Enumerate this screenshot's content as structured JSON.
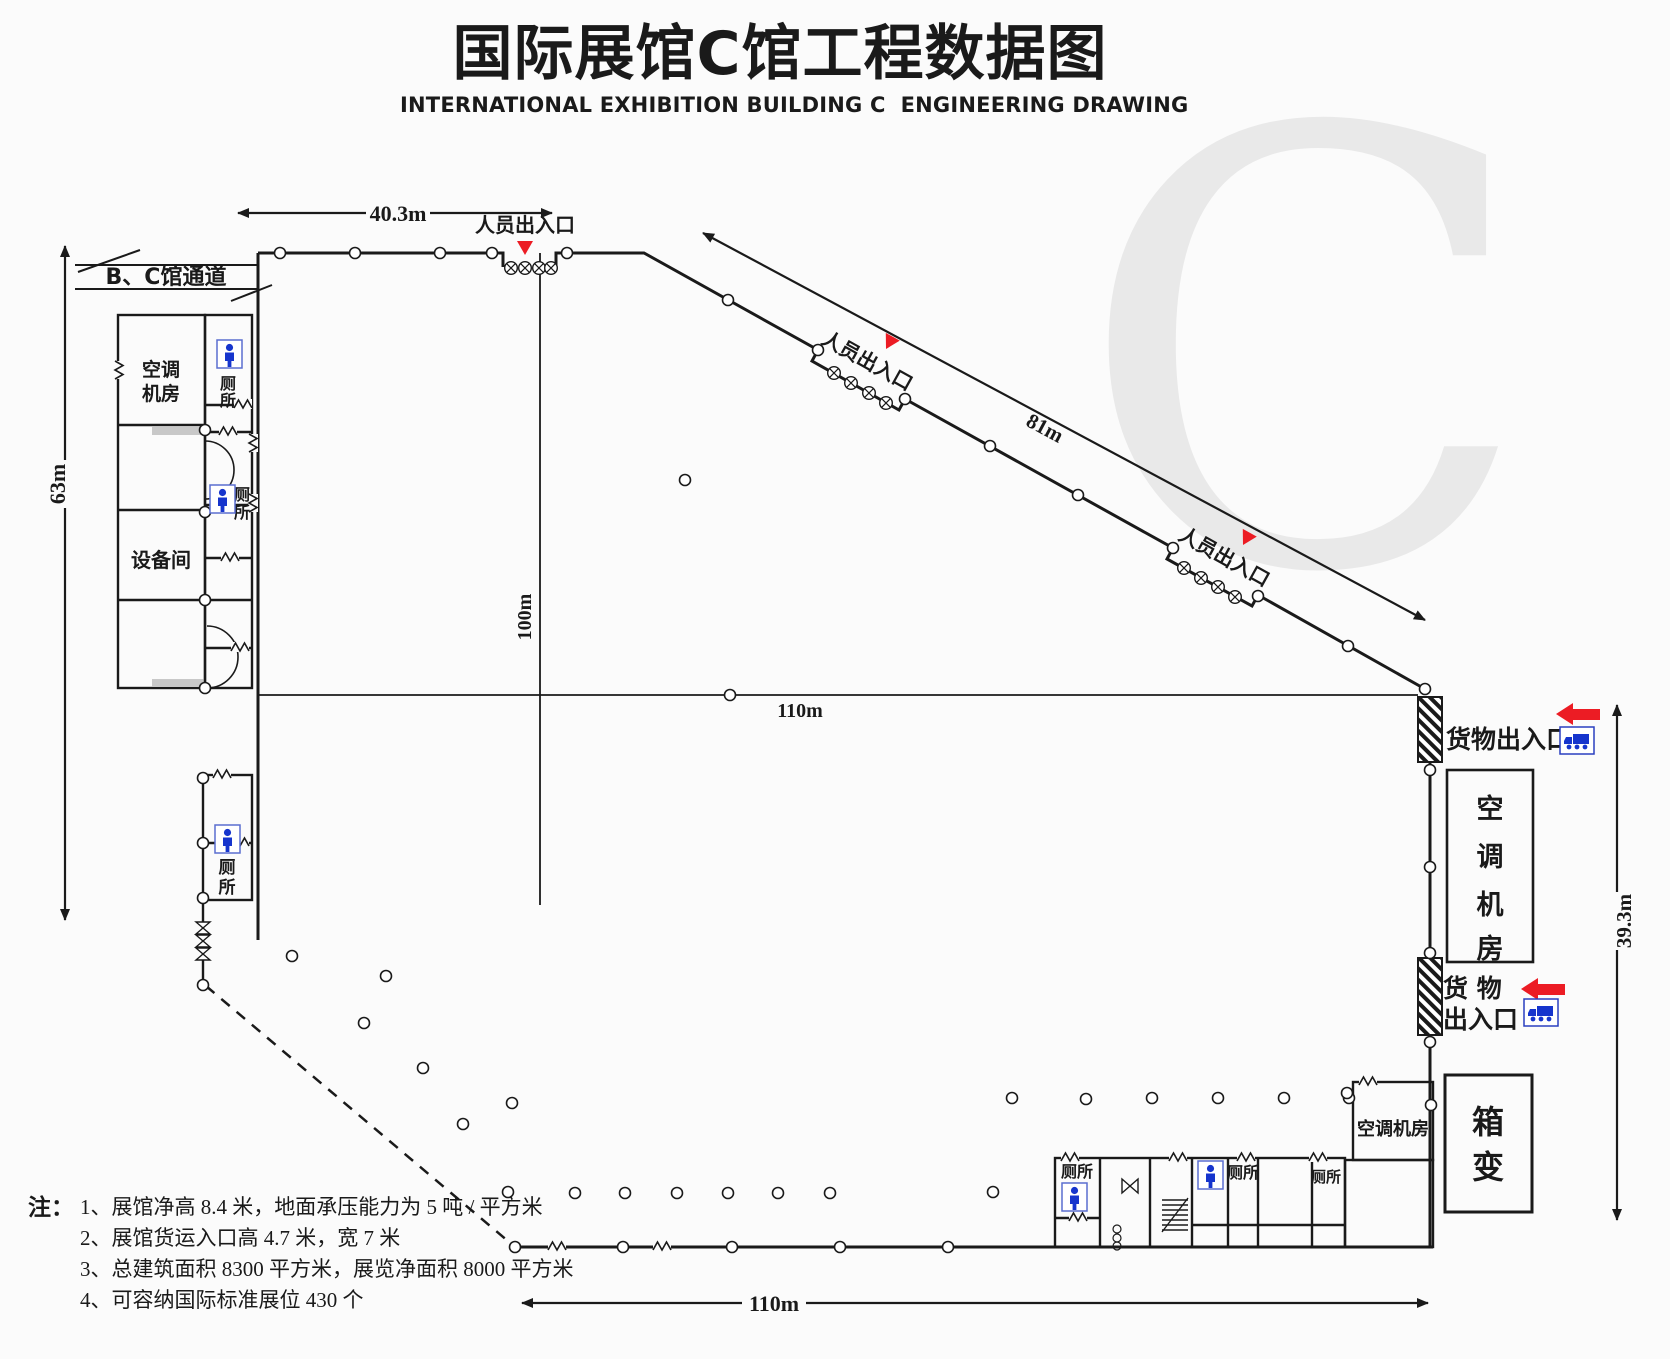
{
  "title": {
    "zh": "国际展馆C馆工程数据图",
    "en": "INTERNATIONAL EXHIBITION BUILDING C  ENGINEERING DRAWING"
  },
  "watermark": "C",
  "dimensions": {
    "top_width": "40.3m",
    "left_height": "63m",
    "hall_width": "100m",
    "mid_width": "110m",
    "diagonal_length": "81m",
    "right_height": "39.3m",
    "bottom_width": "110m"
  },
  "labels": {
    "passage": "B、C馆通道",
    "personnel_entrance": "人员出入口",
    "cargo_entrance": "货物出入口",
    "cargo_word1": "货 物",
    "cargo_word2": "出入口",
    "ac_room_line1": "空调",
    "ac_room_line2": "机房",
    "ac_room": "空调机房",
    "ac_chars": [
      "空",
      "调",
      "机",
      "房"
    ],
    "equipment_room": "设备间",
    "toilet": "厕所",
    "toilet_chars": [
      "厕",
      "所"
    ],
    "box_transformer_chars": [
      "箱",
      "变"
    ]
  },
  "notes": {
    "prefix": "注：",
    "items": [
      "1、展馆净高 8.4 米，地面承压能力为 5 吨 / 平方米",
      "2、展馆货运入口高 4.7 米，宽 7 米",
      "3、总建筑面积 8300 平方米，展览净面积 8000 平方米",
      "4、可容纳国际标准展位 430 个"
    ]
  },
  "colors": {
    "line": "#1a1a1a",
    "accent_red": "#ec1c24",
    "icon_blue": "#1635cd",
    "icon_border_blue": "#5b6ed0",
    "watermark_gray": "#e9e9e9",
    "grey_strip": "#c8c8c8",
    "background": "#fbfbfb"
  }
}
